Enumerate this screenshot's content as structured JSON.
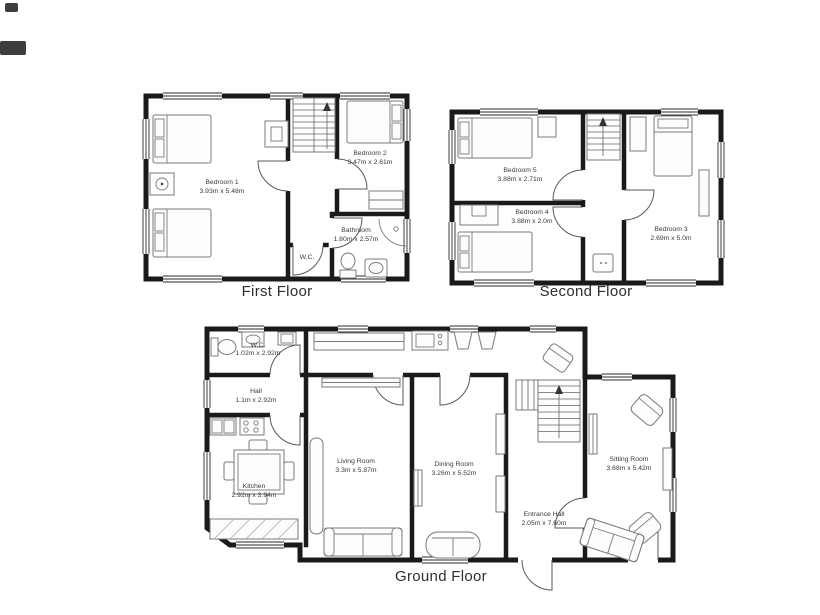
{
  "page": {
    "background": "#ffffff"
  },
  "colors": {
    "wall": "#1a1a1a",
    "furniture": "#7a7a7a",
    "door_arc": "#5a5a5a",
    "label": "#3a3a3a",
    "caption": "#2e2e2e"
  },
  "floors": [
    {
      "name": "First Floor",
      "rooms": [
        {
          "name": "Bedroom 1",
          "dims": "3.93m x 5.48m"
        },
        {
          "name": "Bedroom 2",
          "dims": "3.47m x 2.61m"
        },
        {
          "name": "Bathroom",
          "dims": "1.80m x 2.57m"
        },
        {
          "name": "W.C.",
          "dims": ""
        }
      ]
    },
    {
      "name": "Second Floor",
      "rooms": [
        {
          "name": "Bedroom 5",
          "dims": "3.88m x 2.71m"
        },
        {
          "name": "Bedroom 4",
          "dims": "3.88m x 2.0m"
        },
        {
          "name": "Bedroom 3",
          "dims": "2.69m x 5.0m"
        }
      ]
    },
    {
      "name": "Ground Floor",
      "rooms": [
        {
          "name": "W.C.",
          "dims": "1.02m x 2.92m"
        },
        {
          "name": "Hall",
          "dims": "1.1m x 2.92m"
        },
        {
          "name": "Kitchen",
          "dims": "2.92m x 3.94m"
        },
        {
          "name": "Living Room",
          "dims": "3.3m x 5.87m"
        },
        {
          "name": "Dining Room",
          "dims": "3.26m x 5.52m"
        },
        {
          "name": "Sitting Room",
          "dims": "3.68m x 5.42m"
        },
        {
          "name": "Entrance Hall",
          "dims": "2.05m x 7.60m"
        }
      ]
    }
  ]
}
